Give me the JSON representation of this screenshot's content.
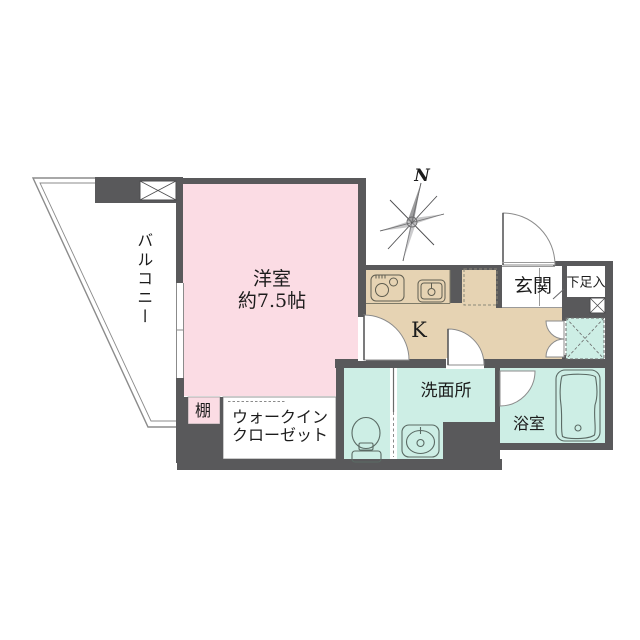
{
  "floor_plan": {
    "compass_label": "N",
    "rooms": {
      "balcony": "バルコニー",
      "western_room_name": "洋室",
      "western_room_size": "約7.5帖",
      "kitchen": "K",
      "entrance": "玄関",
      "shoe_storage": "下足入",
      "washroom": "洗面所",
      "bathroom": "浴室",
      "shelf": "棚",
      "walk_in_closet_line1": "ウォークイン",
      "walk_in_closet_line2": "クローゼット"
    },
    "colors": {
      "wall": "#59595b",
      "room_pink": "#fbdce4",
      "kitchen_tan": "#e6d3b3",
      "wet_mint": "#cdeee5",
      "outline_gray": "#8b8b8b"
    }
  }
}
